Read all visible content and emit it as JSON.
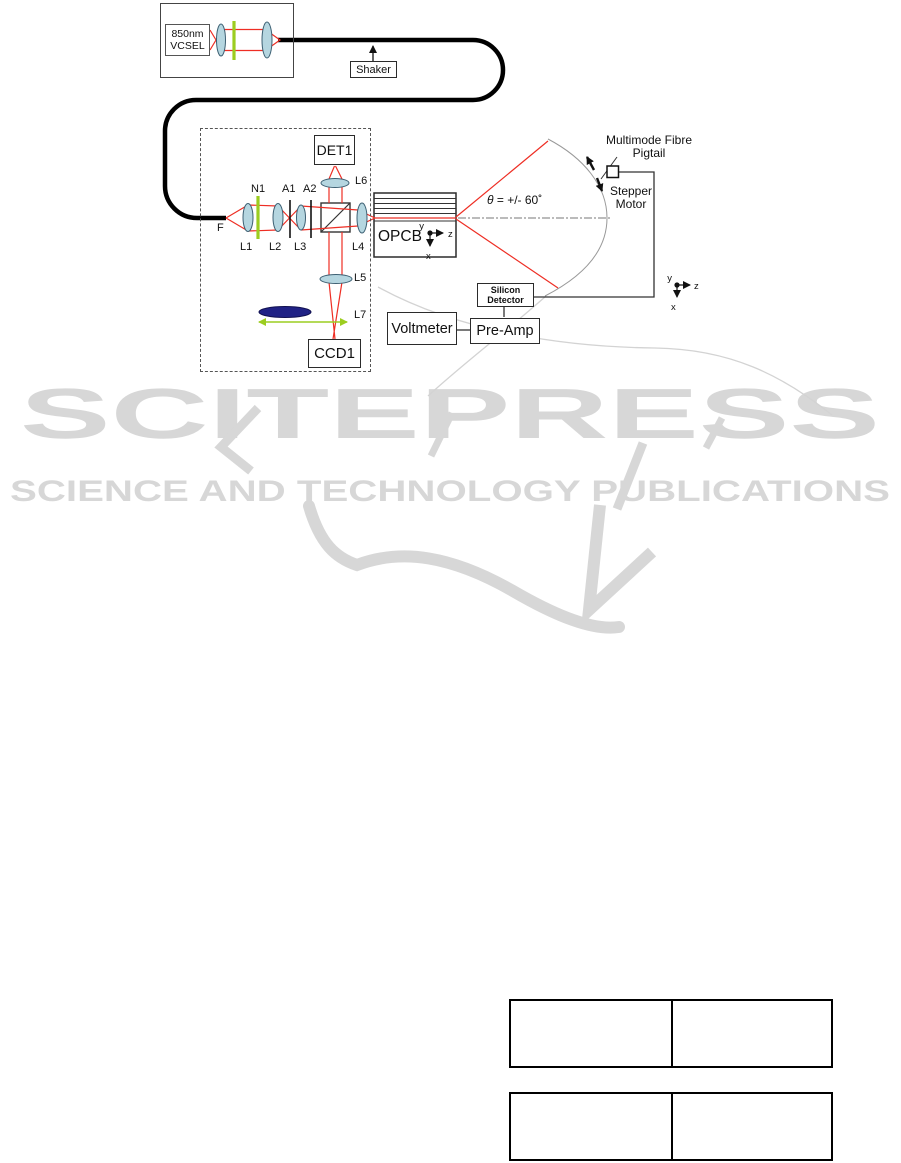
{
  "diagram": {
    "laser": {
      "label_line1": "850nm",
      "label_line2": "VCSEL"
    },
    "shaker": {
      "label": "Shaker"
    },
    "bench": {
      "fiber_label": "F",
      "l1": "L1",
      "l2": "L2",
      "l3": "L3",
      "l4": "L4",
      "l5": "L5",
      "l6": "L6",
      "l7": "L7",
      "filter_label": "N1",
      "a1": "A1",
      "a2": "A2",
      "det1_label": "DET1",
      "ccd1_label": "CCD1"
    },
    "opcb": {
      "label": "OPCB",
      "axes": {
        "x": "x",
        "y": "y",
        "z": "z"
      }
    },
    "scan": {
      "theta_symbol": "θ",
      "theta_rest": " = +/- 60˚",
      "fibre_line1": "Multimode Fibre",
      "fibre_line2": "Pigtail",
      "stepper_line1": "Stepper",
      "stepper_line2": "Motor"
    },
    "detector_chain": {
      "silicon_line1": "Silicon",
      "silicon_line2": "Detector",
      "preamp_label": "Pre-Amp",
      "voltmeter_label": "Voltmeter"
    },
    "right_axes": {
      "x": "x",
      "y": "y",
      "z": "z"
    },
    "colors": {
      "beam_red": "#ee2e24",
      "lens_fill": "#b5d6e0",
      "lens_stroke": "#3d6073",
      "filter_green": "#9ccd20",
      "dark_lens": "#202285",
      "watermark_gray": "#d7d7d7"
    }
  },
  "watermark": {
    "line1": "SCITEPRESS",
    "line2": "SCIENCE AND TECHNOLOGY PUBLICATIONS"
  },
  "tables": [
    {
      "rows": [
        [
          "",
          ""
        ]
      ]
    },
    {
      "rows": [
        [
          "",
          ""
        ]
      ]
    }
  ]
}
